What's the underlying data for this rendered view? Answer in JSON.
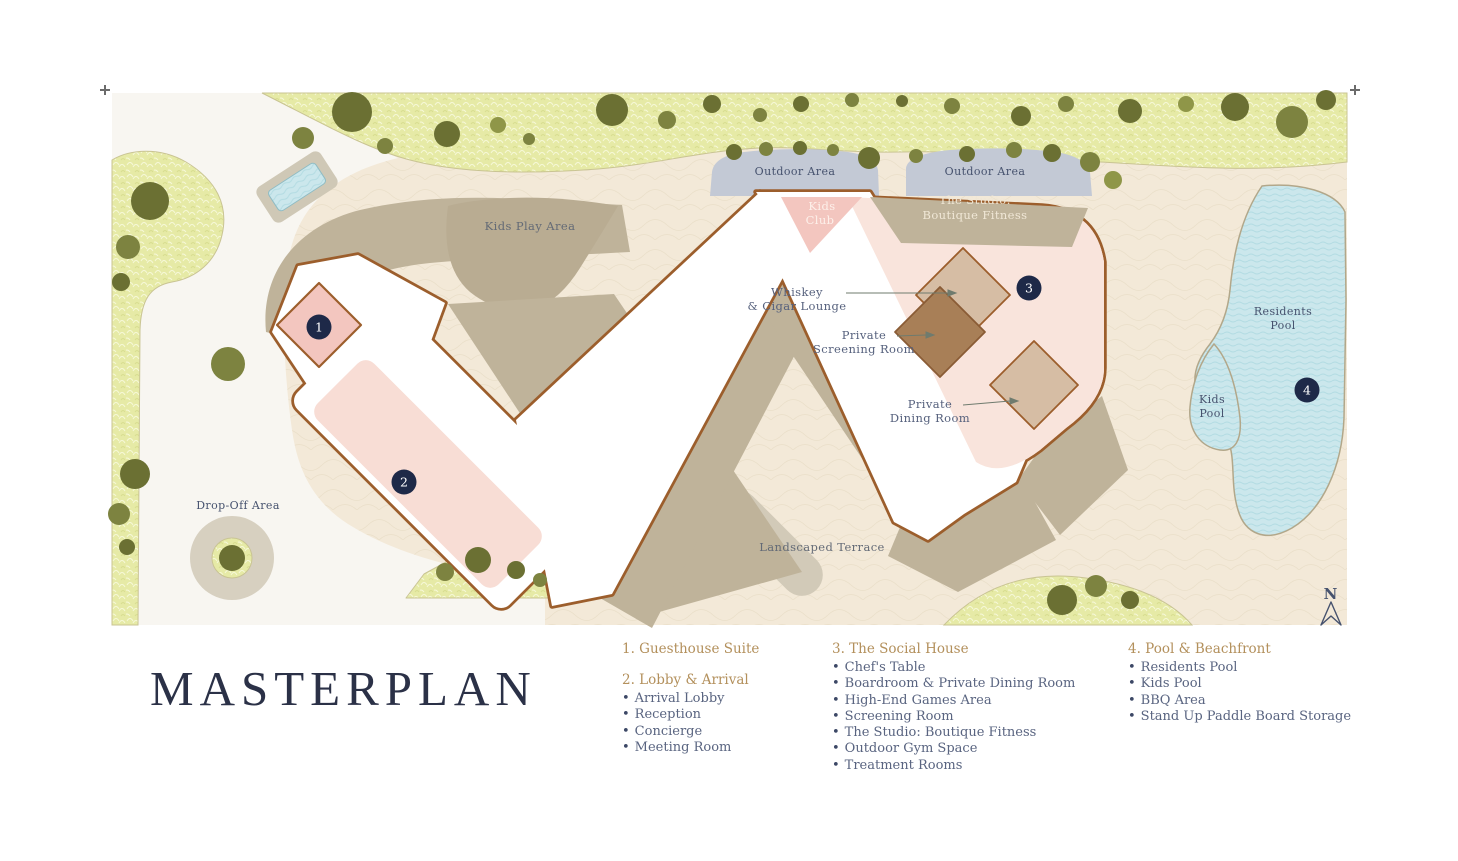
{
  "masterplan": {
    "title": "MASTERPLAN"
  },
  "plan": {
    "labels": {
      "kids_play_area": "Kids Play Area",
      "outdoor_area_left": "Outdoor Area",
      "outdoor_area_right": "Outdoor Area",
      "kids_club_line1": "Kids",
      "kids_club_line2": "Club",
      "studio_line1": "The Studio:",
      "studio_line2": "Boutique Fitness",
      "whiskey_line1": "Whiskey",
      "whiskey_line2": "& Cigar Lounge",
      "screening_line1": "Private",
      "screening_line2": "Screening Room",
      "dining_line1": "Private",
      "dining_line2": "Dining Room",
      "drop_off_area": "Drop-Off Area",
      "landscaped_terrace": "Landscaped Terrace",
      "residents_pool_line1": "Residents",
      "residents_pool_line2": "Pool",
      "kids_pool_line1": "Kids",
      "kids_pool_line2": "Pool",
      "north": "N"
    },
    "markers": [
      "1",
      "2",
      "3",
      "4"
    ]
  },
  "legend": {
    "groups": [
      {
        "heading": "1. Guesthouse Suite",
        "items": []
      },
      {
        "heading": "2. Lobby & Arrival",
        "items": [
          "Arrival Lobby",
          "Reception",
          "Concierge",
          "Meeting Room"
        ]
      },
      {
        "heading": "3. The Social House",
        "items": [
          "Chef's Table",
          "Boardroom & Private Dining Room",
          "High-End Games Area",
          "Screening Room",
          "The Studio: Boutique Fitness",
          "Outdoor Gym Space",
          "Treatment Rooms"
        ]
      },
      {
        "heading": "4. Pool & Beachfront",
        "items": [
          "Residents Pool",
          "Kids Pool",
          "BBQ Area",
          "Stand Up Paddle Board Storage"
        ]
      }
    ]
  },
  "colors": {
    "legend_gold": "#b3905c",
    "navy_text": "#46526e",
    "marker_navy": "#1e2948",
    "building_outline": "#9c5e2c",
    "pink_bar": "#f8ddd5",
    "pink_mid": "#f3c6bf",
    "pink_pale": "#f9e4dc",
    "khaki": "#bfb39a",
    "grass": "#e6eaa6",
    "pool_blue": "#cbe7ec",
    "sand": "#f3e9d8",
    "outdoor_blue": "#c3c9d5",
    "road": "#f8f6f1"
  }
}
